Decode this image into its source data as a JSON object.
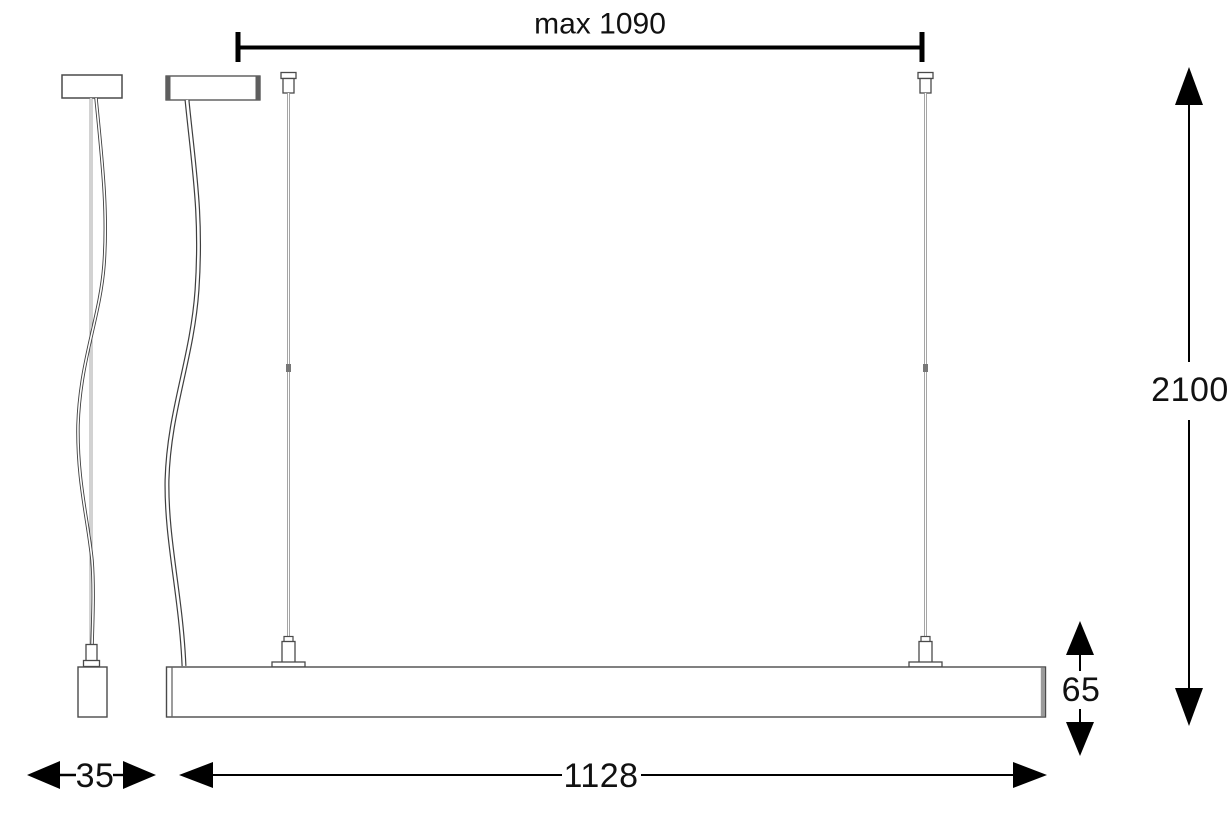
{
  "drawing": {
    "dimensions": {
      "max_suspension": {
        "label": "max 1090"
      },
      "total_drop": {
        "label": "2100"
      },
      "body_height": {
        "label": "65"
      },
      "body_length": {
        "label": "1128"
      },
      "profile_width": {
        "label": "35"
      }
    },
    "colors": {
      "dimension_ink": "#000000",
      "outline_ink": "#3f3f3f",
      "wire_gray": "#8f8f8f",
      "canopy_end_gray": "#5e5e5e",
      "fixture_endcap_gray": "#9a9a9a",
      "background": "#ffffff"
    }
  }
}
